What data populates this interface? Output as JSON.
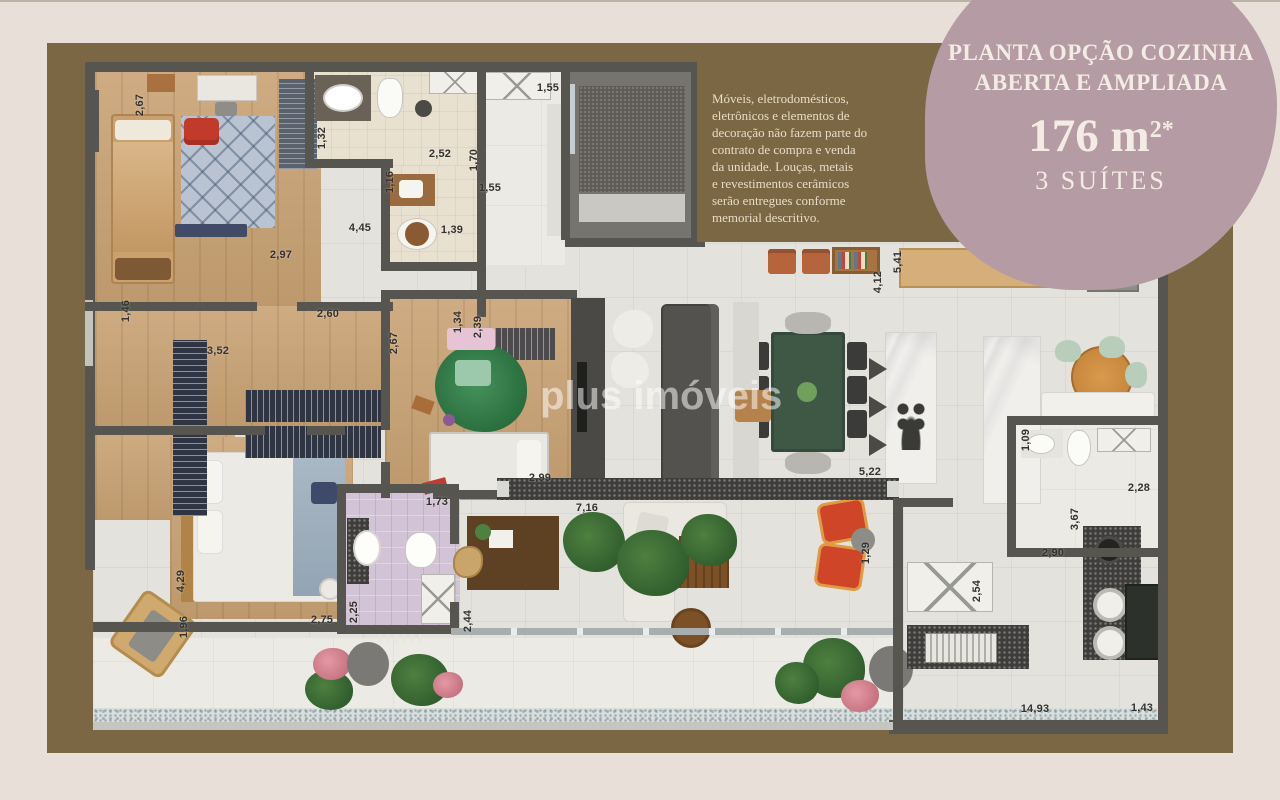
{
  "poster": {
    "type": "apartment floor plan marketing poster"
  },
  "colors": {
    "margin": "#e7dfd8",
    "panel": "#7b6743",
    "blob": "#b59ba3",
    "blob_text": "#f3ece5",
    "wall": "#57554f",
    "dim_text": "#34322e"
  },
  "badge": {
    "line1": "PLANTA OPÇÃO COZINHA",
    "line2": "ABERTA E AMPLIADA",
    "area": "176 m",
    "area_sup": "2*",
    "suites": "3 SUÍTES"
  },
  "disclaimer": {
    "lines": [
      "Móveis, eletrodomésticos,",
      "eletrônicos e elementos de",
      "decoração não fazem parte do",
      "contrato de compra e venda",
      "da unidade. Louças, metais",
      "e revestimentos cerâmicos",
      "serão entregues conforme",
      "memorial descritivo."
    ]
  },
  "watermark": {
    "text": "plus imóveis"
  },
  "dimensions": [
    {
      "v": "2,67",
      "x": 55,
      "y": 43,
      "r": true
    },
    {
      "v": "1,32",
      "x": 237,
      "y": 76,
      "r": true
    },
    {
      "v": "2,52",
      "x": 355,
      "y": 92
    },
    {
      "v": "1,70",
      "x": 389,
      "y": 98,
      "r": true
    },
    {
      "v": "1,16",
      "x": 305,
      "y": 120,
      "r": true
    },
    {
      "v": "1,55",
      "x": 463,
      "y": 26
    },
    {
      "v": "1,55",
      "x": 405,
      "y": 126
    },
    {
      "v": "4,45",
      "x": 275,
      "y": 166
    },
    {
      "v": "1,39",
      "x": 367,
      "y": 168
    },
    {
      "v": "2,97",
      "x": 196,
      "y": 193
    },
    {
      "v": "2,60",
      "x": 243,
      "y": 252
    },
    {
      "v": "1,46",
      "x": 41,
      "y": 249,
      "r": true
    },
    {
      "v": "3,52",
      "x": 133,
      "y": 289
    },
    {
      "v": "2,67",
      "x": 309,
      "y": 281,
      "r": true
    },
    {
      "v": "1,34",
      "x": 373,
      "y": 260,
      "r": true
    },
    {
      "v": "2,39",
      "x": 393,
      "y": 265,
      "r": true
    },
    {
      "v": "4,12",
      "x": 793,
      "y": 220,
      "r": true
    },
    {
      "v": "5,41",
      "x": 813,
      "y": 200,
      "r": true
    },
    {
      "v": "4,82",
      "x": 1057,
      "y": 193
    },
    {
      "v": "2,99",
      "x": 455,
      "y": 416
    },
    {
      "v": "1,73",
      "x": 352,
      "y": 440
    },
    {
      "v": "7,16",
      "x": 502,
      "y": 446
    },
    {
      "v": "5,22",
      "x": 785,
      "y": 410
    },
    {
      "v": "1,29",
      "x": 781,
      "y": 491,
      "r": true
    },
    {
      "v": "1,09",
      "x": 941,
      "y": 378,
      "r": true
    },
    {
      "v": "2,28",
      "x": 1054,
      "y": 426
    },
    {
      "v": "3,67",
      "x": 990,
      "y": 457,
      "r": true
    },
    {
      "v": "2,90",
      "x": 968,
      "y": 491
    },
    {
      "v": "2,54",
      "x": 892,
      "y": 529,
      "r": true
    },
    {
      "v": "4,29",
      "x": 96,
      "y": 519,
      "r": true
    },
    {
      "v": "1,96",
      "x": 99,
      "y": 565,
      "r": true
    },
    {
      "v": "2,75",
      "x": 237,
      "y": 558
    },
    {
      "v": "2,25",
      "x": 269,
      "y": 550,
      "r": true
    },
    {
      "v": "2,44",
      "x": 383,
      "y": 559,
      "r": true
    },
    {
      "v": "14,93",
      "x": 950,
      "y": 647
    },
    {
      "v": "1,43",
      "x": 1057,
      "y": 646
    }
  ]
}
